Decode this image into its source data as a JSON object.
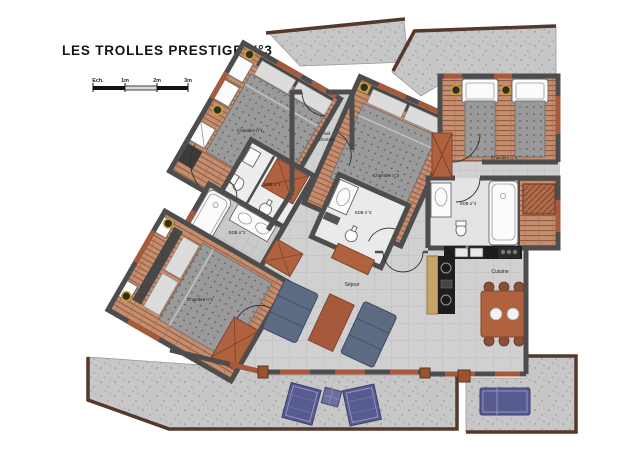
{
  "title": "LES TROLLES PRESTIGE N°3",
  "scale": {
    "label": "Ech.",
    "tick1": "1m",
    "tick2": "2m",
    "tick3": "3m"
  },
  "rooms": {
    "chambre1": "Chambre n°1",
    "chambre2": "Chambre n°2",
    "chambre3": "Chambre n°3",
    "chambre4": "Chambre n°4",
    "sdb1": "SDB n°1",
    "sdb2": "SDB n°2",
    "sdb3": "SDB n°3",
    "sdb4": "SDB n°4",
    "hall_line1": "hall",
    "hall_line2": "d'entrée",
    "sejour": "Séjour",
    "cuisine": "Cuisine"
  },
  "colors": {
    "wall": "#4d4d4d",
    "terracotta": "#a7593c",
    "wood_floor": "#c58e6e",
    "wood_stripe": "#8d5742",
    "tile_floor": "#d0d0d0",
    "concrete": "#c7c7c7",
    "sofa": "#5d6b82",
    "lounger": "#585b90",
    "outline_brown": "#53382b",
    "lamp_ring": "#c9a227"
  }
}
